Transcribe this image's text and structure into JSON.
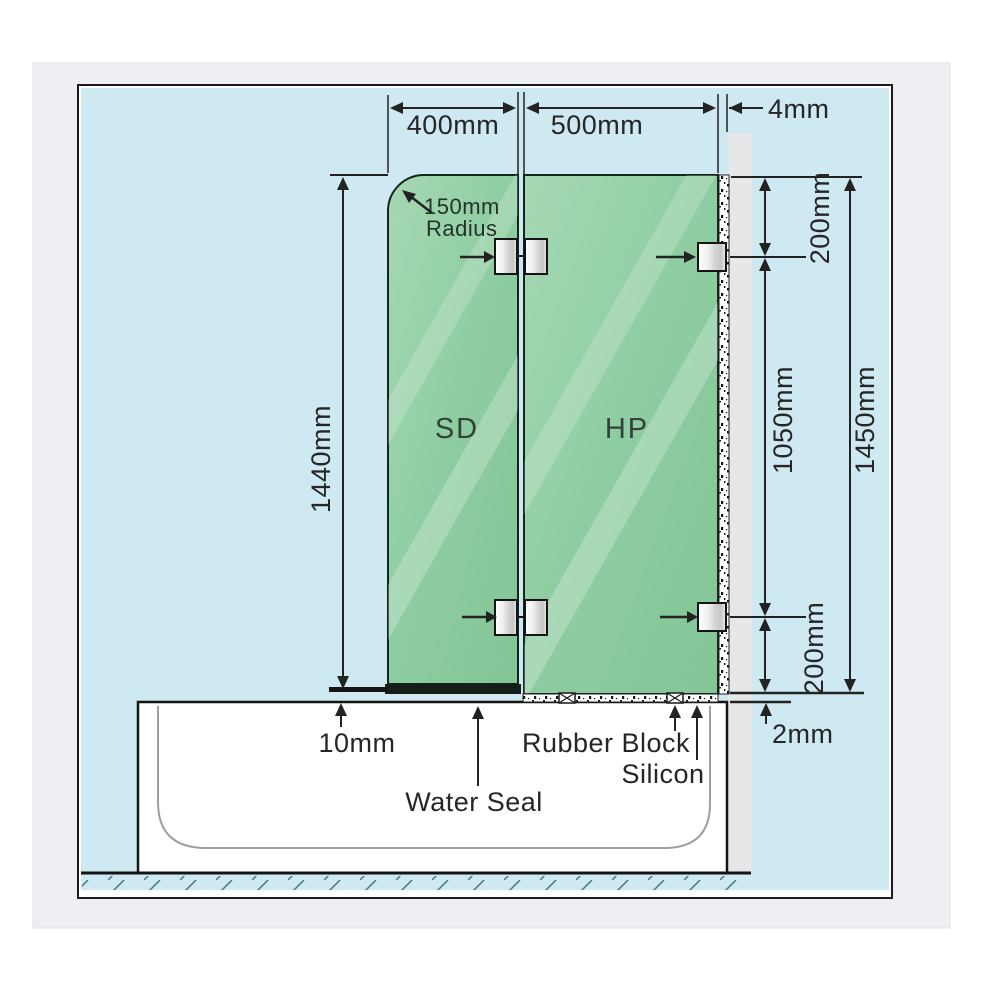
{
  "title": "Shower screen over-bath installation diagram",
  "diagram": {
    "panel_labels": {
      "sd": "SD",
      "hp": "HP"
    },
    "dimensions": {
      "sd_width": "400mm",
      "hp_width": "500mm",
      "wall_gap": "4mm",
      "radius_line1": "150mm",
      "radius_line2": "Radius",
      "sd_height": "1440mm",
      "top_offset": "200mm",
      "bracket_span": "1050mm",
      "hp_height": "1450mm",
      "bottom_offset": "200mm",
      "bottom_gap": "10mm",
      "silicon_gap": "2mm"
    },
    "annotations": {
      "water_seal": "Water Seal",
      "rubber_block": "Rubber Block",
      "silicon": "Silicon"
    },
    "colors": {
      "background_blue": "#cfe9f2",
      "glass_green": "#8ecda1",
      "wall_grey": "#e5e7e8",
      "line": "#232323",
      "outer_panel": "#edeff2"
    }
  }
}
